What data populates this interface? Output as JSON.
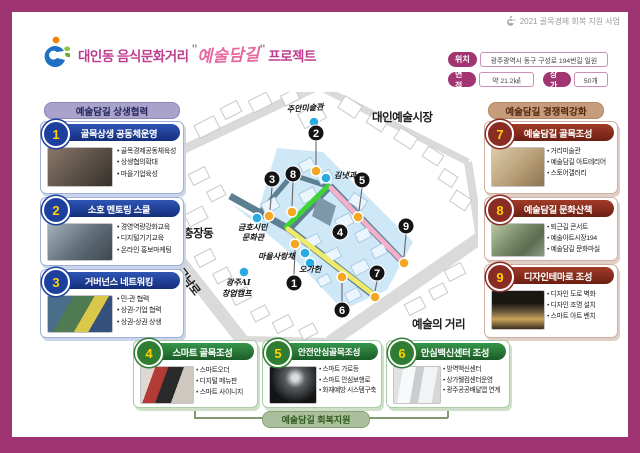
{
  "header": {
    "program": "2021 골목경제 회복 지원 사업",
    "title_prefix": "대인동 음식문화거리",
    "quote": "\"",
    "title_script": "예술담길",
    "title_suffix": "프로젝트",
    "info": {
      "location_label": "위치",
      "location_value": "광주광역시 동구 구성로 194번길 일원",
      "area_label": "면적",
      "area_value": "약 21.2㎢",
      "shops_label": "상가",
      "shops_value": "50개"
    }
  },
  "sections": {
    "left": {
      "title": "예술담길 상생협력",
      "items": [
        {
          "num": "1",
          "title": "골목상생 공동체운영",
          "bullets": [
            "골목경제공동체육성",
            "상생협의확대",
            "마을기업육성"
          ]
        },
        {
          "num": "2",
          "title": "소호 멘토링 스쿨",
          "bullets": [
            "경영역량강화교육",
            "디지털기기교육",
            "온라인 홍보마케팅"
          ]
        },
        {
          "num": "3",
          "title": "거버넌스 네트워킹",
          "bullets": [
            "민-관 협력",
            "상권-기업 협력",
            "상권-상권 상생"
          ]
        }
      ]
    },
    "right": {
      "title": "예술담길 경쟁력강화",
      "items": [
        {
          "num": "7",
          "title": "예술담길 골목조성",
          "bullets": [
            "거리미술관",
            "예술담길 아트테리어",
            "스토어갤러리"
          ]
        },
        {
          "num": "8",
          "title": "예술담길 문화산책",
          "bullets": [
            "퇴근길 콘서트",
            "예술아트시장194",
            "예술담길 문화마실"
          ]
        },
        {
          "num": "9",
          "title": "디자인테마로 조성",
          "bullets": [
            "디자인 도로 벽화",
            "디자인 조명 설치",
            "스마트 아트 벤치"
          ]
        }
      ]
    },
    "bottom": {
      "items": [
        {
          "num": "4",
          "title": "스마트 골목조성",
          "bullets": [
            "스마트오더",
            "디지털 메뉴판",
            "스마트 사이니지"
          ]
        },
        {
          "num": "5",
          "title": "안전안심골목조성",
          "bullets": [
            "스마트 가로등",
            "스마트 안심보행로",
            "화재예방 시스템구축"
          ]
        },
        {
          "num": "6",
          "title": "안심백신센터 조성",
          "bullets": [
            "방역백신센터",
            "상가웰컴센터운영",
            "광주공공배달앱 연계"
          ]
        }
      ],
      "footer": "예술담길 회복지원"
    }
  },
  "map": {
    "area_labels": [
      "대인예술시장",
      "충장동",
      "금남로",
      "예술의 거리"
    ],
    "landmarks": [
      {
        "label": "주안미술관"
      },
      {
        "label": "김냇과"
      },
      {
        "label": "금호시민",
        "label2": "문화관"
      },
      {
        "label": "마을사랑채"
      },
      {
        "label": "오가헌"
      },
      {
        "label": "광주AI",
        "label2": "창업캠프"
      }
    ],
    "markers": [
      "1",
      "2",
      "3",
      "4",
      "5",
      "6",
      "7",
      "8",
      "9"
    ]
  },
  "colors": {
    "frame": "#9e3472",
    "title": "#bf3d8e",
    "script_pink": "#e8679f",
    "blue": "#1d3f9e",
    "maroon": "#8a2c24",
    "green": "#2e7d32",
    "left_pill_bg": "#a9a2cb",
    "right_pill_bg": "#c69c7c",
    "footer_pill_bg": "#aabf9b",
    "map_highlight": "#cfe8f8",
    "route_green": "#3fd435",
    "route_pink": "#f6afcb",
    "route_yellow": "#f0ea6a",
    "dot_blue": "#29abe2",
    "dot_orange": "#f5a623"
  }
}
